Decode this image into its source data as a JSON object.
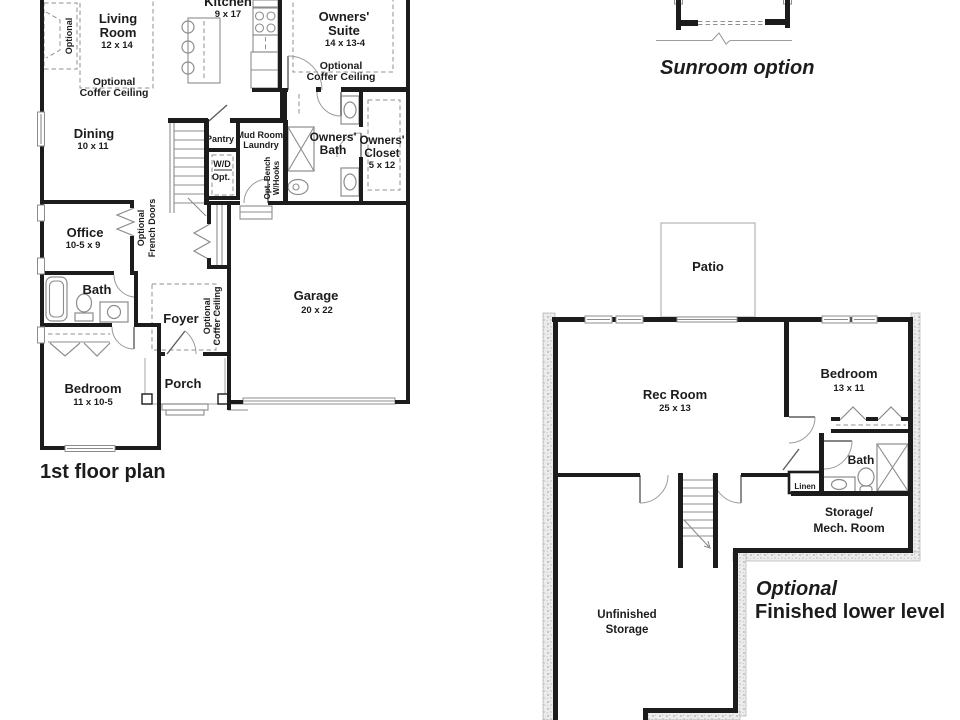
{
  "colors": {
    "background": "#ffffff",
    "wall": "#1c1c1c",
    "thin_line": "#8c8c8c",
    "light_line": "#b3b3b3",
    "text": "#1c1c1c"
  },
  "first_floor": {
    "title": "1st floor plan",
    "rooms": {
      "kitchen": {
        "name": "Kitchen",
        "dims": "9 x 17"
      },
      "living": {
        "line1": "Living",
        "line2": "Room",
        "dims": "12 x 14"
      },
      "owners_suite": {
        "line1": "Owners'",
        "line2": "Suite",
        "dims": "14 x 13-4"
      },
      "dining": {
        "name": "Dining",
        "dims": "10 x 11"
      },
      "office": {
        "name": "Office",
        "dims": "10-5 x 9"
      },
      "bath": {
        "name": "Bath"
      },
      "bedroom": {
        "name": "Bedroom",
        "dims": "11 x 10-5"
      },
      "foyer": {
        "name": "Foyer"
      },
      "porch": {
        "name": "Porch"
      },
      "garage": {
        "name": "Garage",
        "dims": "20 x 22"
      },
      "pantry": {
        "name": "Pantry"
      },
      "mud_room": {
        "line1": "Mud Room/",
        "line2": "Laundry"
      },
      "wd": {
        "line1": "W/D",
        "line2": "Opt."
      },
      "owners_bath": {
        "line1": "Owners'",
        "line2": "Bath"
      },
      "owners_closet": {
        "line1": "Owners'",
        "line2": "Closet",
        "dims": "5 x 12"
      }
    },
    "notes": {
      "coffer_line1": "Optional",
      "coffer_line2": "Coffer Ceiling",
      "fireplace": "Optional",
      "french_line1": "Optional",
      "french_line2": "French Doors",
      "bench_line1": "Opt. Bench",
      "bench_line2": "W/Hooks"
    }
  },
  "sunroom": {
    "title": "Sunroom option"
  },
  "lower_level": {
    "title_line1": "Optional",
    "title_line2": "Finished lower level",
    "rooms": {
      "patio": {
        "name": "Patio"
      },
      "rec_room": {
        "name": "Rec Room",
        "dims": "25 x 13"
      },
      "bedroom": {
        "name": "Bedroom",
        "dims": "13 x 11"
      },
      "bath": {
        "name": "Bath"
      },
      "linen": {
        "name": "Linen"
      },
      "storage_mech": {
        "line1": "Storage/",
        "line2": "Mech. Room"
      },
      "unfinished": {
        "line1": "Unfinished",
        "line2": "Storage"
      }
    }
  }
}
